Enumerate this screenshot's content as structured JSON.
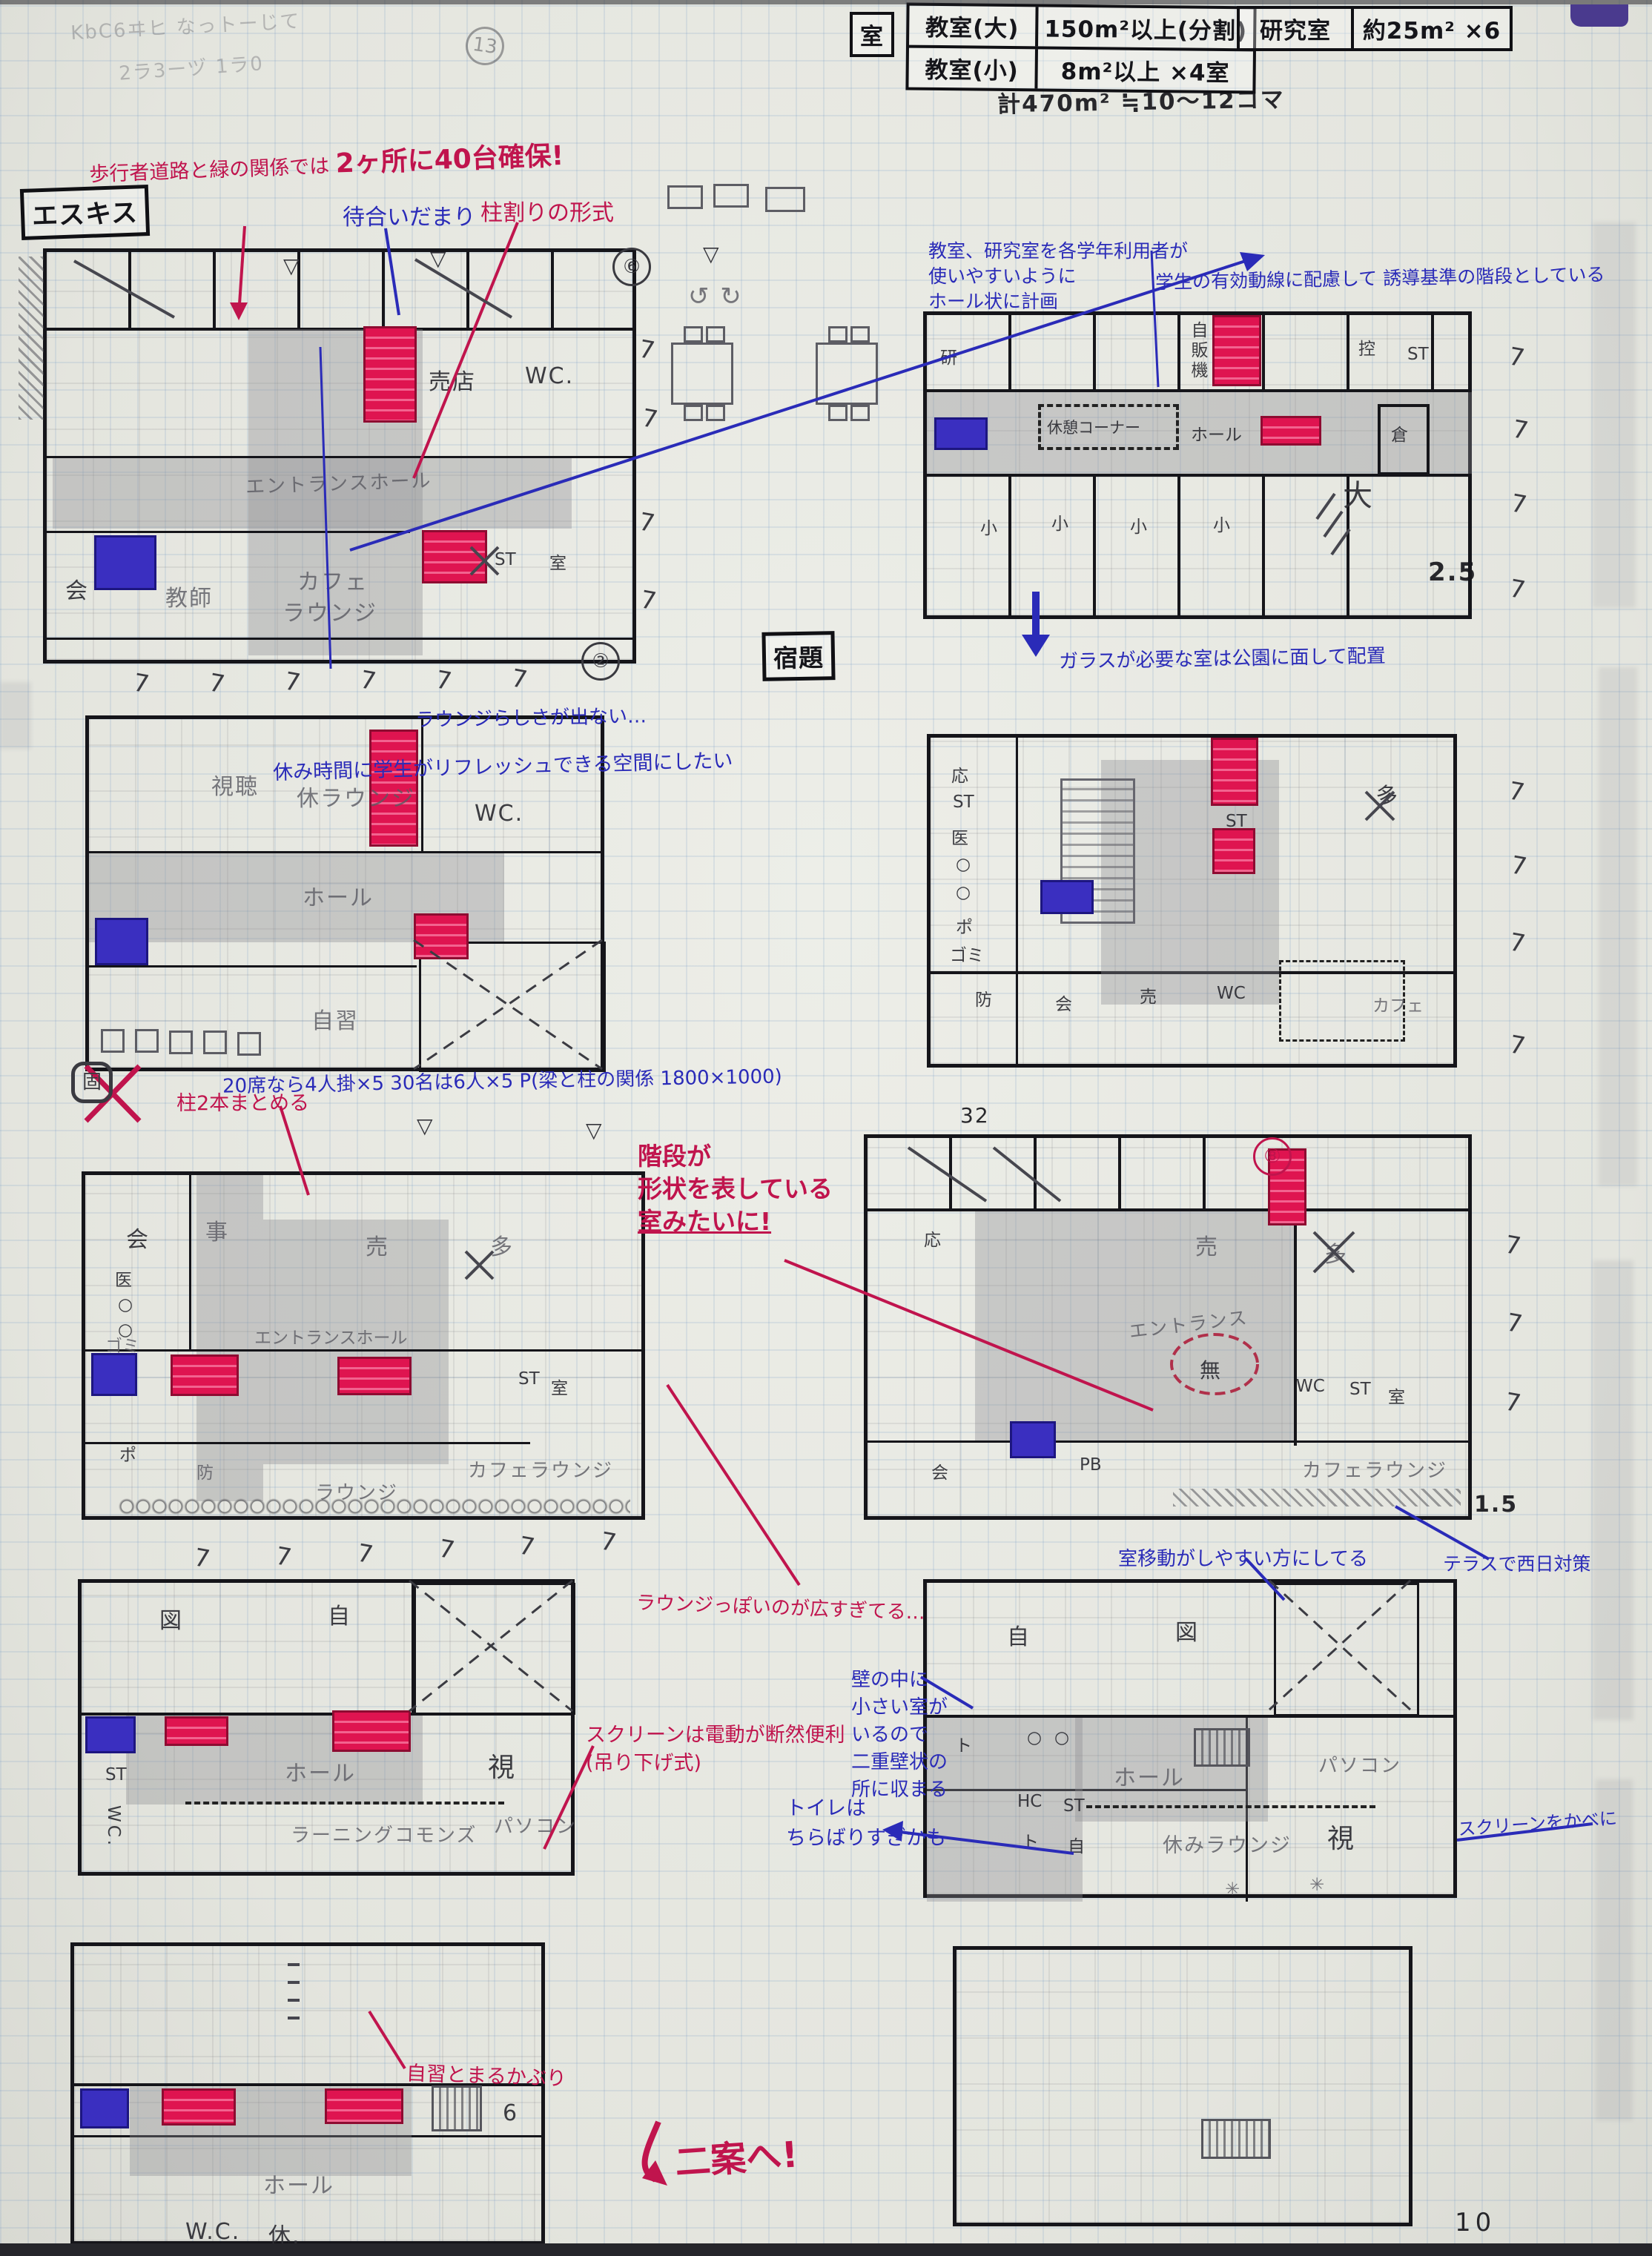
{
  "header": {
    "shitsu": "室",
    "t1r1c1": "教室(大)",
    "t1r1c2": "150m²以上(分割)",
    "t1r2c1": "教室(小)",
    "t1r2c2": "8m²以上 ×4室",
    "t2c1": "研究室",
    "t2c2": "約25m² ×6",
    "total": "計470m² ≒10〜12コマ",
    "scrib1": "KbC6ヰヒ なっトーじて",
    "scrib2": "2ラ3ーヅ 1ラ0"
  },
  "tags": {
    "esquisse": "エスキス",
    "shukudai": "宿題"
  },
  "marks": {
    "seven": "7",
    "two": "②",
    "six": "⑥",
    "eight": "⑧",
    "thirteen": "13",
    "enclosedB": "固",
    "v25": "2.5",
    "v15": "1.5",
    "v32": "32",
    "v6": "6",
    "tri": "▽",
    "rotarrows": "↺ ↻",
    "page": "10",
    "asterisk": "✳"
  },
  "notes": {
    "a1a": "歩行者道路と緑の関係では",
    "a1b": "2ヶ所に40台確保!",
    "a2": "待合いだまり",
    "a3": "柱割りの形式",
    "a4l1": "教室、研究室を各学年利用者が",
    "a4l2": "使いやすいように",
    "a4l3": "ホール状に計画",
    "a5": "学生の有効動線に配慮して 誘導基準の階段としている",
    "a6": "休み時間に学生がリフレッシュできる空間にしたい",
    "a7": "20席なら4人掛×5 30名は6人×5 P(梁と柱の関係 1800×1000)",
    "a8": "柱2本まとめる",
    "a9l1": "階段が",
    "a9l2": "形状を表している",
    "a9l3": "室みたいに!",
    "a10": "ガラスが必要な室は公園に面して配置",
    "a11": "ラウンジっぽいのが広すぎてる…",
    "a12l1": "壁の中に",
    "a12l2": "小さい室が",
    "a12l3": "いるので",
    "a12l4": "二重壁状の",
    "a12l5": "所に収まる",
    "a13l1": "スクリーンは電動が断然便利",
    "a13l2": "(吊り下げ式)",
    "a14": "自習とまるかぶり",
    "a15l1": "トイレは",
    "a15l2": "ちらばりすぎかも",
    "a16": "室移動がしやすい方にしてる",
    "a17": "テラスで西日対策",
    "a18": "スクリーンをかべに",
    "a19": "二案へ!",
    "p1note": "ラウンジらしさが出ない…"
  },
  "rooms": {
    "p1": {
      "baiten": "売店",
      "wc": "WC.",
      "hall": "エントランスホール",
      "st": "ST",
      "shitsu": "室",
      "kai": "会",
      "kyoshi": "教師",
      "cafe": "カフェ",
      "lounge": "ラウンジ",
      "ta": "多"
    },
    "ptr": {
      "ken": "研",
      "jihanki": "自販機",
      "hikae": "控",
      "st": "ST",
      "kura": "倉",
      "kyukei": "休憩コーナー",
      "hall": "ホール",
      "sho": "小",
      "dai": "大"
    },
    "p2": {
      "shicho": "視聴",
      "lounge": "休ラウンジ",
      "wc": "WC.",
      "hall": "ホール",
      "jishu": "自習"
    },
    "p5": {
      "o": "応",
      "st": "ST",
      "i": "医",
      "maru": "○",
      "po": "ポ",
      "gomi": "ゴミ",
      "bo": "防",
      "kai": "会",
      "bai": "売",
      "wc": "WC",
      "ta": "多",
      "cafe": "カフェ"
    },
    "p3": {
      "kai": "会",
      "ji": "事",
      "bai": "売",
      "ta": "多",
      "i": "医",
      "maru": "○",
      "gomi": "ゴミ",
      "hall": "エントランスホール",
      "st": "ST",
      "shitsu": "室",
      "po": "ポ",
      "bo": "防",
      "lounge": "ラウンジ",
      "cafelounge": "カフェラウンジ"
    },
    "p4": {
      "o": "応",
      "bai": "売",
      "ta": "多",
      "entrance": "エントランス",
      "mu": "無",
      "wc": "WC",
      "st": "ST",
      "shitsu": "室",
      "cafelounge": "カフェラウンジ",
      "pb": "PB",
      "kai": "会"
    },
    "p6": {
      "zu": "図",
      "ji": "自",
      "hall": "ホール",
      "shi": "視",
      "st": "ST",
      "wc": "WC.",
      "learning": "ラーニングコモンズ",
      "pc": "パソコン"
    },
    "p8": {
      "ji": "自",
      "zu": "図",
      "to": "ト",
      "maru": "○",
      "hall": "ホール",
      "pc": "パソコン",
      "hc": "HC",
      "st": "ST",
      "to2": "ト",
      "ji2": "自",
      "lounge": "休みラウンジ",
      "shi": "視"
    },
    "p7": {
      "hall": "ホール",
      "wc": "W.C.",
      "kyu": "休."
    }
  }
}
